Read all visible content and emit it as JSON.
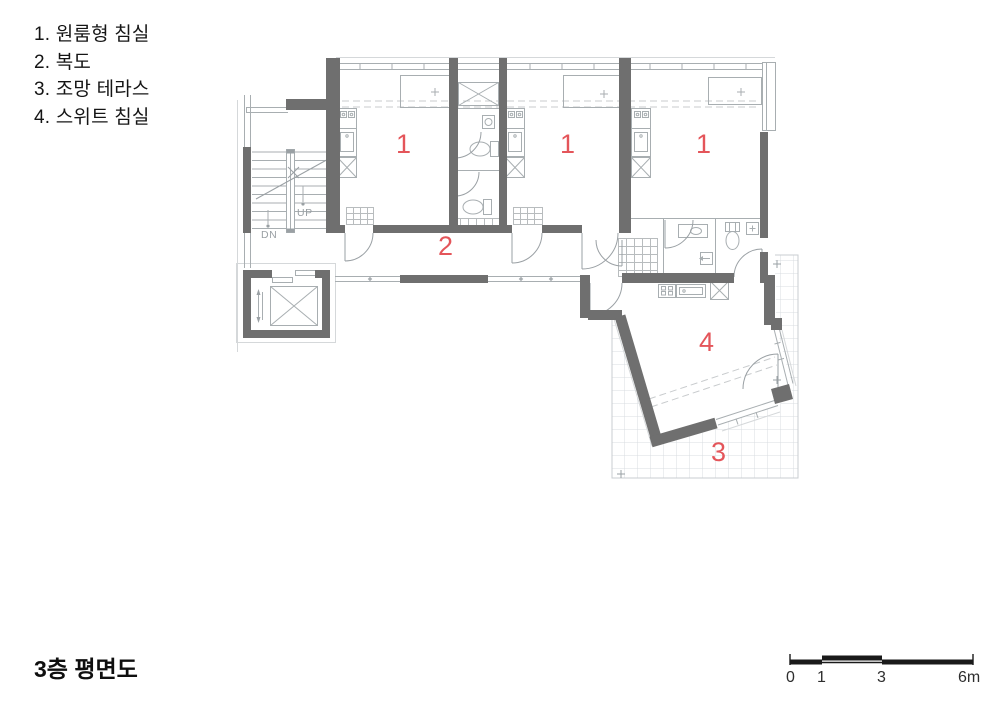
{
  "legend": {
    "items": [
      "1. 원룸형 침실",
      "2. 복도",
      "3. 조망 테라스",
      "4. 스위트 침실"
    ]
  },
  "title": "3층 평면도",
  "plan": {
    "room_numbers": {
      "studio": "1",
      "corridor": "2",
      "terrace": "3",
      "suite": "4"
    },
    "stairs": {
      "up": "UP",
      "down": "DN"
    }
  },
  "scale_bar": {
    "labels": [
      "0",
      "1",
      "3",
      "6m"
    ]
  },
  "colors": {
    "wall_gray": "#6f6f6f",
    "thin_line_gray": "#a8aeb1",
    "room_number_red": "#e4555a",
    "terrace_grid": "#d9dce0",
    "scale_bar_black": "#1a1a1a"
  }
}
